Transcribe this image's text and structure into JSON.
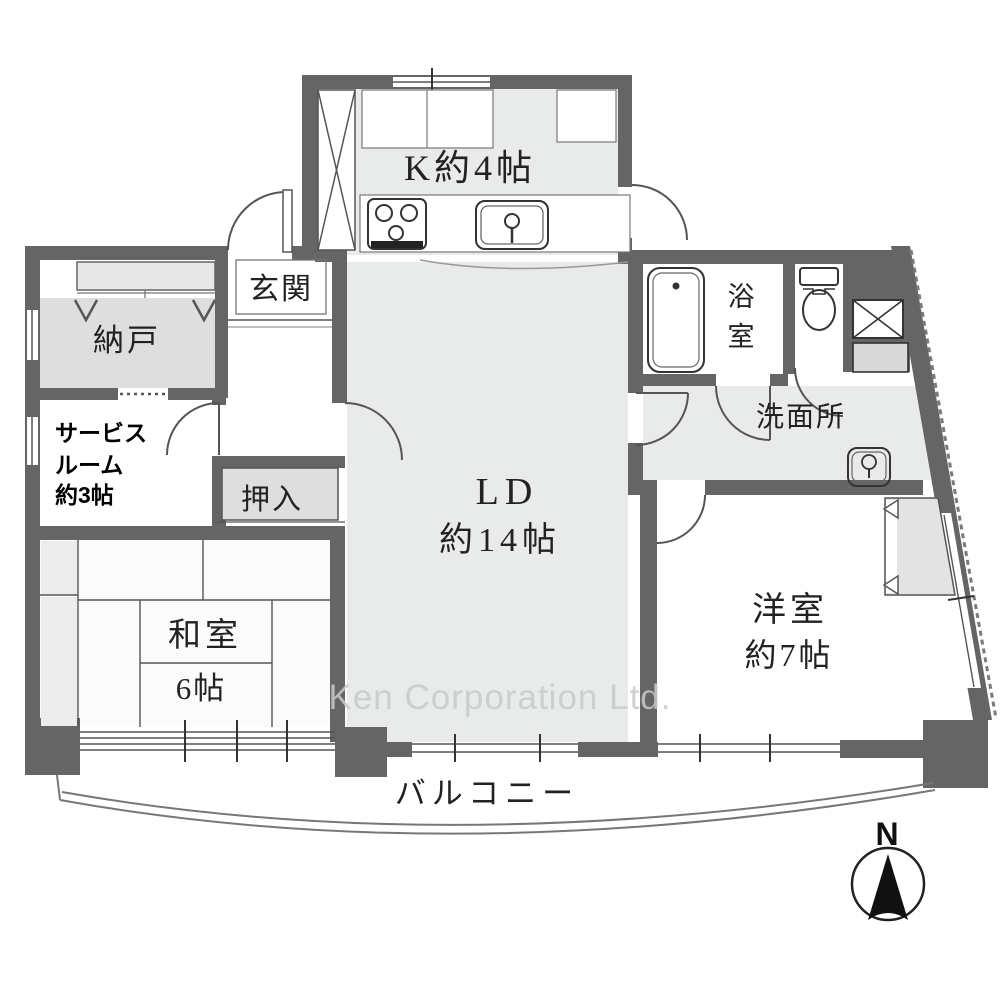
{
  "floorplan": {
    "watermark": "Ken Corporation Ltd.",
    "compass_label": "N",
    "rooms": {
      "kitchen": "K約4帖",
      "entrance": "玄関",
      "storage": "納戸",
      "service_room_line1": "サービス",
      "service_room_line2": "ルーム",
      "service_room_line3": "約3帖",
      "closet_oshiire": "押入",
      "living_dining_line1": "LD",
      "living_dining_line2": "約14帖",
      "japanese_room": "和室",
      "japanese_room_size": "6帖",
      "western_room": "洋室",
      "western_room_size": "約7帖",
      "bathroom_char1": "浴",
      "bathroom_char2": "室",
      "washroom": "洗面所",
      "balcony": "バルコニー"
    },
    "colors": {
      "wall": "#656565",
      "floor_light": "#e9eaea",
      "floor_mid": "#dedede",
      "line": "#555555"
    }
  }
}
